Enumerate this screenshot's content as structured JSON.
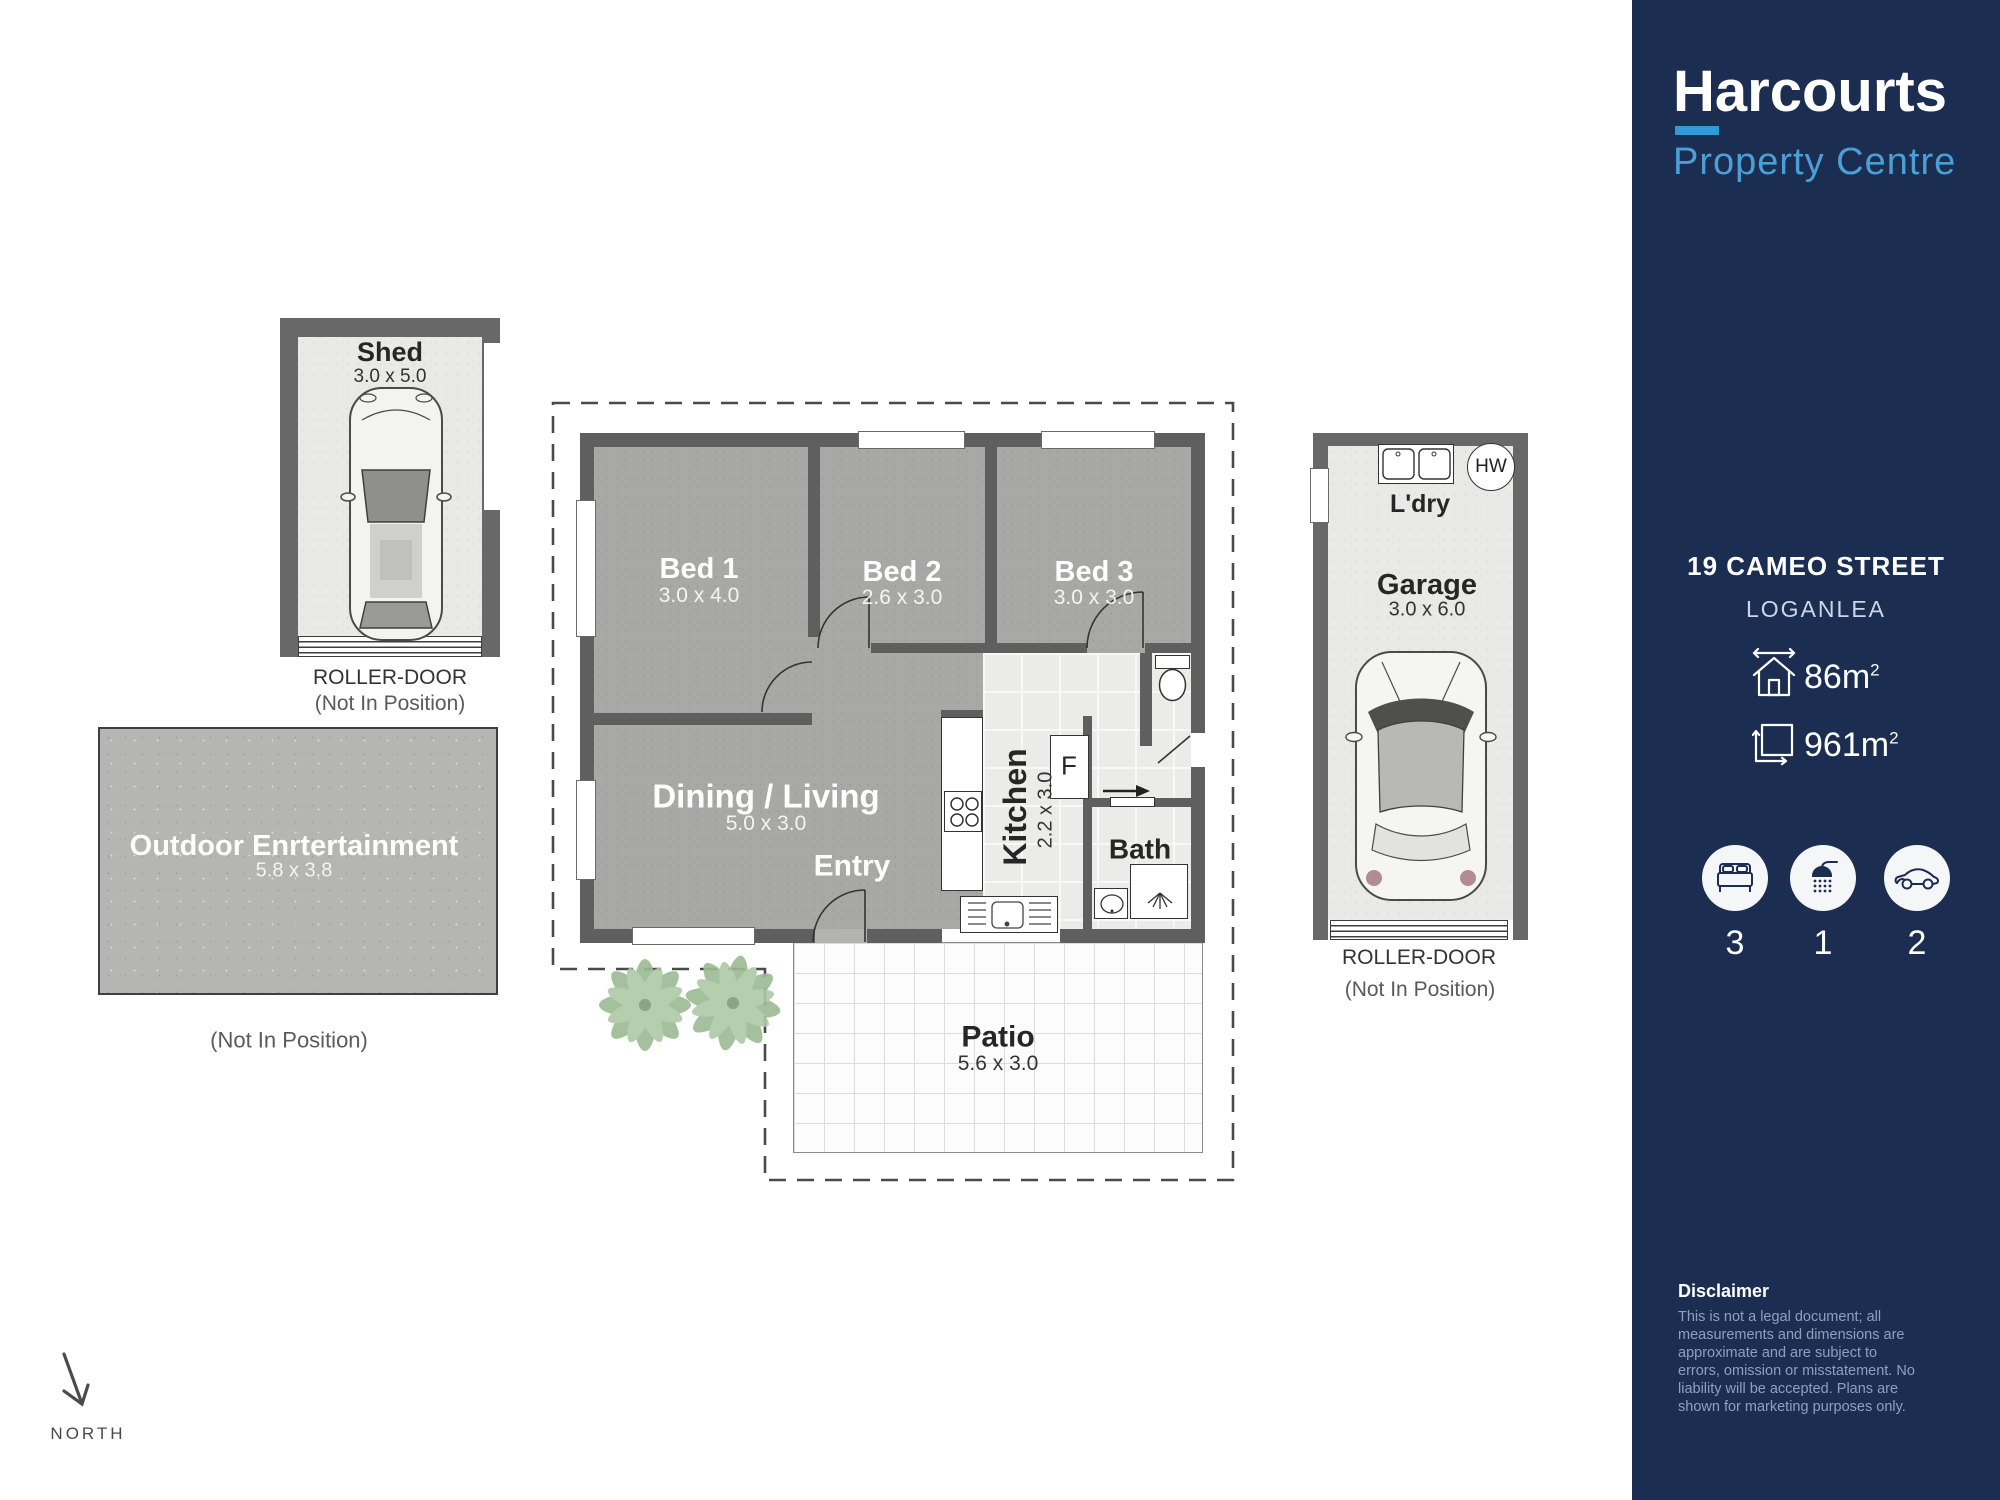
{
  "brand": {
    "name": "Harcourts",
    "tagline": "Property Centre",
    "navy": "#1c2d52",
    "accent_blue": "#2f9cd7"
  },
  "property": {
    "address_line1": "19 CAMEO STREET",
    "address_line2": "LOGANLEA",
    "floor_area": {
      "value": "86m",
      "sup": "2"
    },
    "land_area": {
      "value": "961m",
      "sup": "2"
    },
    "stats": {
      "beds": "3",
      "baths": "1",
      "cars": "2"
    }
  },
  "rooms": {
    "shed": {
      "name": "Shed",
      "dims": "3.0 x 5.0",
      "roller": "ROLLER-DOOR",
      "note": "(Not In Position)"
    },
    "outdoor": {
      "name": "Outdoor Enrtertainment",
      "dims": "5.8 x 3.8",
      "note": "(Not In Position)"
    },
    "bed1": {
      "name": "Bed 1",
      "dims": "3.0 x 4.0"
    },
    "bed2": {
      "name": "Bed 2",
      "dims": "2.6 x 3.0"
    },
    "bed3": {
      "name": "Bed 3",
      "dims": "3.0 x 3.0"
    },
    "dining": {
      "name": "Dining / Living",
      "dims": "5.0 x 3.0"
    },
    "entry": {
      "name": "Entry"
    },
    "kitchen": {
      "name": "Kitchen",
      "dims": "2.2 x 3.0"
    },
    "bath": {
      "name": "Bath"
    },
    "fridge": {
      "label": "F"
    },
    "patio": {
      "name": "Patio",
      "dims": "5.6 x 3.0"
    },
    "garage": {
      "name": "Garage",
      "dims": "3.0 x 6.0",
      "laundry": "L'dry",
      "hot_water": "HW",
      "roller": "ROLLER-DOOR",
      "note": "(Not In Position)"
    }
  },
  "compass": {
    "label": "NORTH"
  },
  "icons": {
    "floor_area_icon": "house-outline",
    "land_area_icon": "land-square-arrows",
    "beds_icon": "bed",
    "baths_icon": "shower",
    "cars_icon": "car",
    "north_icon": "arrow-down"
  },
  "disclaimer": {
    "title": "Disclaimer",
    "lines": [
      "This is not a legal document; all",
      "measurements and dimensions are",
      "approximate and are subject to",
      "errors, omission or misstatement. No",
      "liability will be accepted. Plans are",
      "shown for marketing purposes only."
    ]
  }
}
